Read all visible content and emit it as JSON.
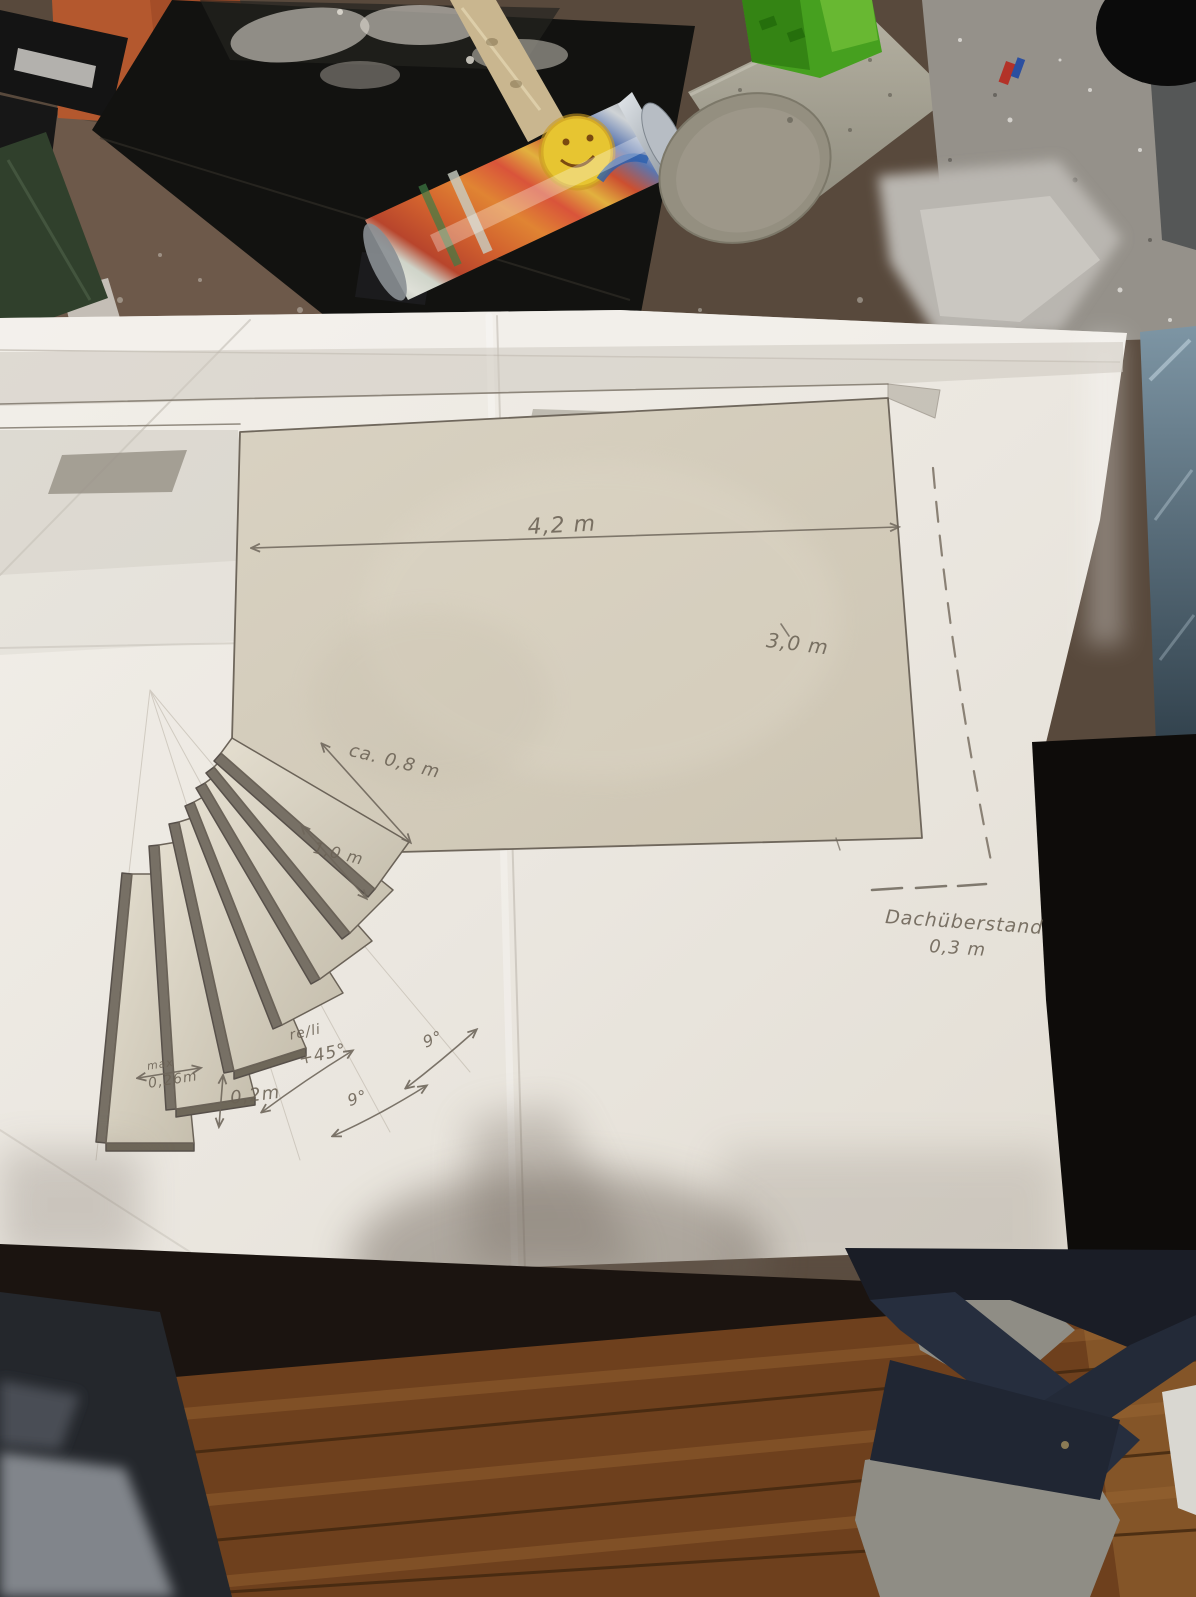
{
  "photo": {
    "sketch_annotations": {
      "terrace_width": "4,2 m",
      "terrace_depth": "3,0 m",
      "top_step_width": "ca. 0,8 m",
      "step_length": "1,0 m",
      "tread_depth_prefix": "max",
      "tread_depth": "0,26m",
      "riser_height": "0,2m",
      "turn_direction": "re/li",
      "turn_angle": "+45°",
      "step_angle_a": "9°",
      "step_angle_b": "9°",
      "roof_overhang_label": "Dachüberstand",
      "roof_overhang_value": "0,3 m"
    },
    "colors": {
      "paper": "#ece8e1",
      "pencil": "#6f675c",
      "tread_fill": "#ddd6c7",
      "terrace_fill": "#d7cfbe",
      "wood_floor": "#6e401d",
      "table_surface": "#58493c",
      "dust_surface": "#95918a",
      "sandal": "#232a38",
      "sock": "#8f8d85",
      "denim": "#24272c",
      "concrete": "#a39f90",
      "green_object": "#46a01f",
      "orange_box": "#b4582e"
    }
  }
}
